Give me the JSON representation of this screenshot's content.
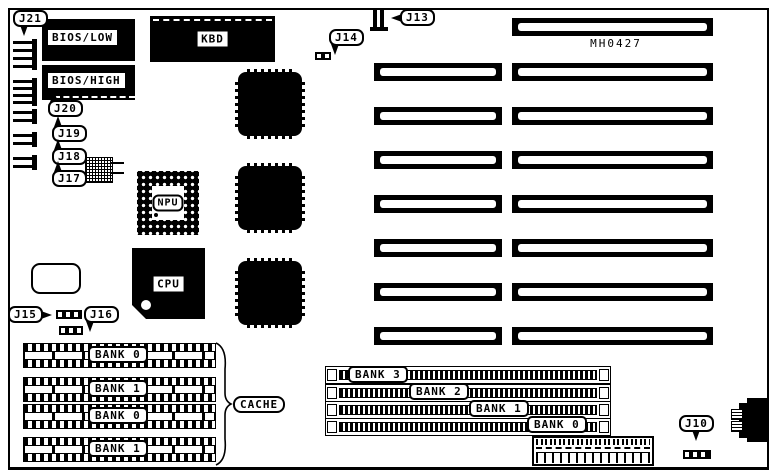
{
  "board": {
    "part_number": "MH0427"
  },
  "chips": {
    "bios_low": "BIOS/LOW",
    "bios_high": "BIOS/HIGH",
    "kbd": "KBD",
    "npu": "NPU",
    "cpu": "CPU"
  },
  "labels": {
    "cache": "CACHE",
    "j10": "J10",
    "j13": "J13",
    "j14": "J14",
    "j15": "J15",
    "j16": "J16",
    "j17": "J17",
    "j18": "J18",
    "j19": "J19",
    "j20": "J20",
    "j21": "J21"
  },
  "cache_banks": [
    "BANK 0",
    "BANK 1",
    "BANK 0",
    "BANK 1"
  ],
  "simm_banks": [
    "BANK 3",
    "BANK 2",
    "BANK 1",
    "BANK 0"
  ]
}
